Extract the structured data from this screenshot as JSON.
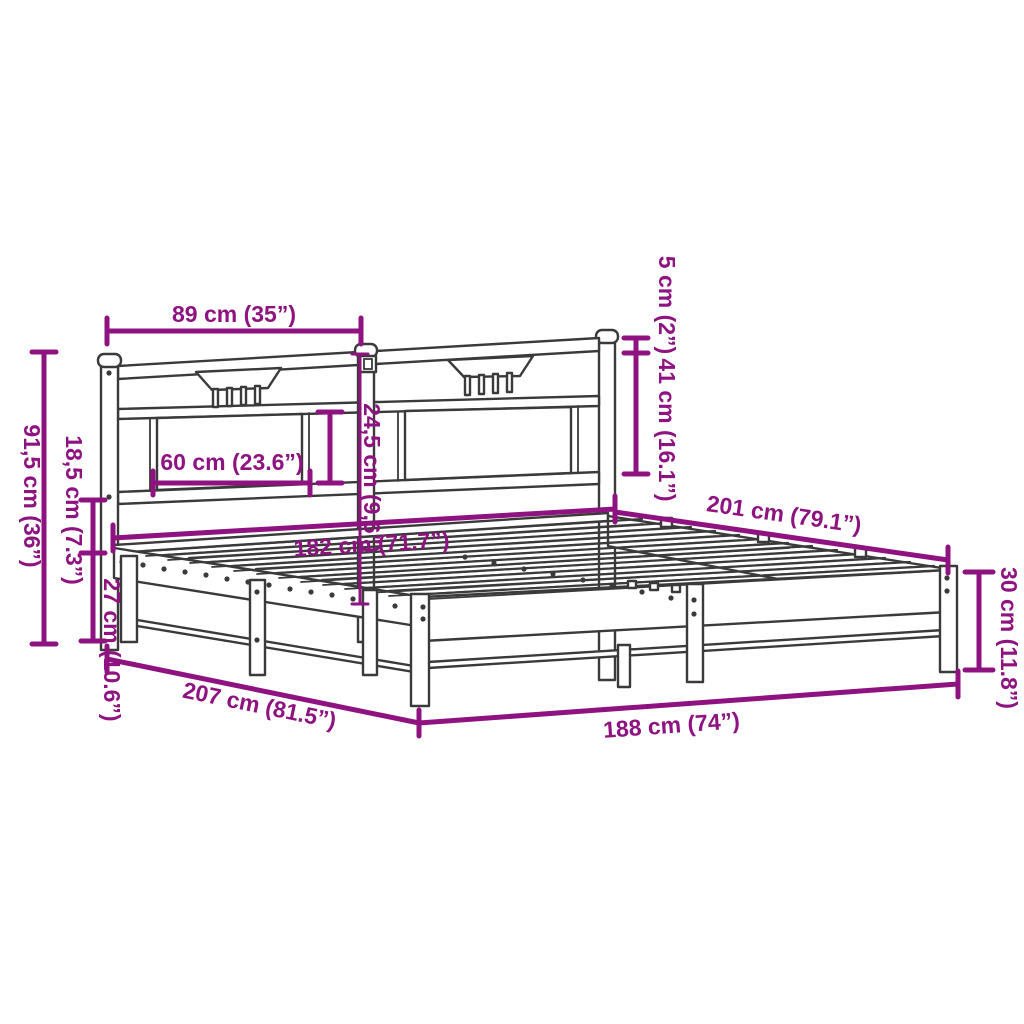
{
  "diagram": {
    "type": "product-dimension-diagram",
    "subject": "metal bed frame with headboard",
    "colors": {
      "accent": "#8E1380",
      "line": "#3A3A3A",
      "background": "#FFFFFF"
    },
    "dimensions": {
      "headboard_section_width": "89 cm (35”)",
      "post_cap_height": "5 cm (2”)",
      "headboard_upper_height": "41 cm (16.1”)",
      "headboard_panel_height": "24,5 cm (9,6”)",
      "headboard_panel_width": "60 cm (23.6”)",
      "headboard_total_height": "91,5 cm (36”)",
      "frame_rail_height": "18,5 cm (7.3”)",
      "underbed_clearance": "27 cm (10.6”)",
      "slat_surface_width": "182 cm (71.7”)",
      "side_inner_length": "201 cm (79.1”)",
      "frame_side_height": "30 cm (11.8”)",
      "total_length": "207 cm (81.5”)",
      "total_width": "188 cm (74”)"
    }
  }
}
